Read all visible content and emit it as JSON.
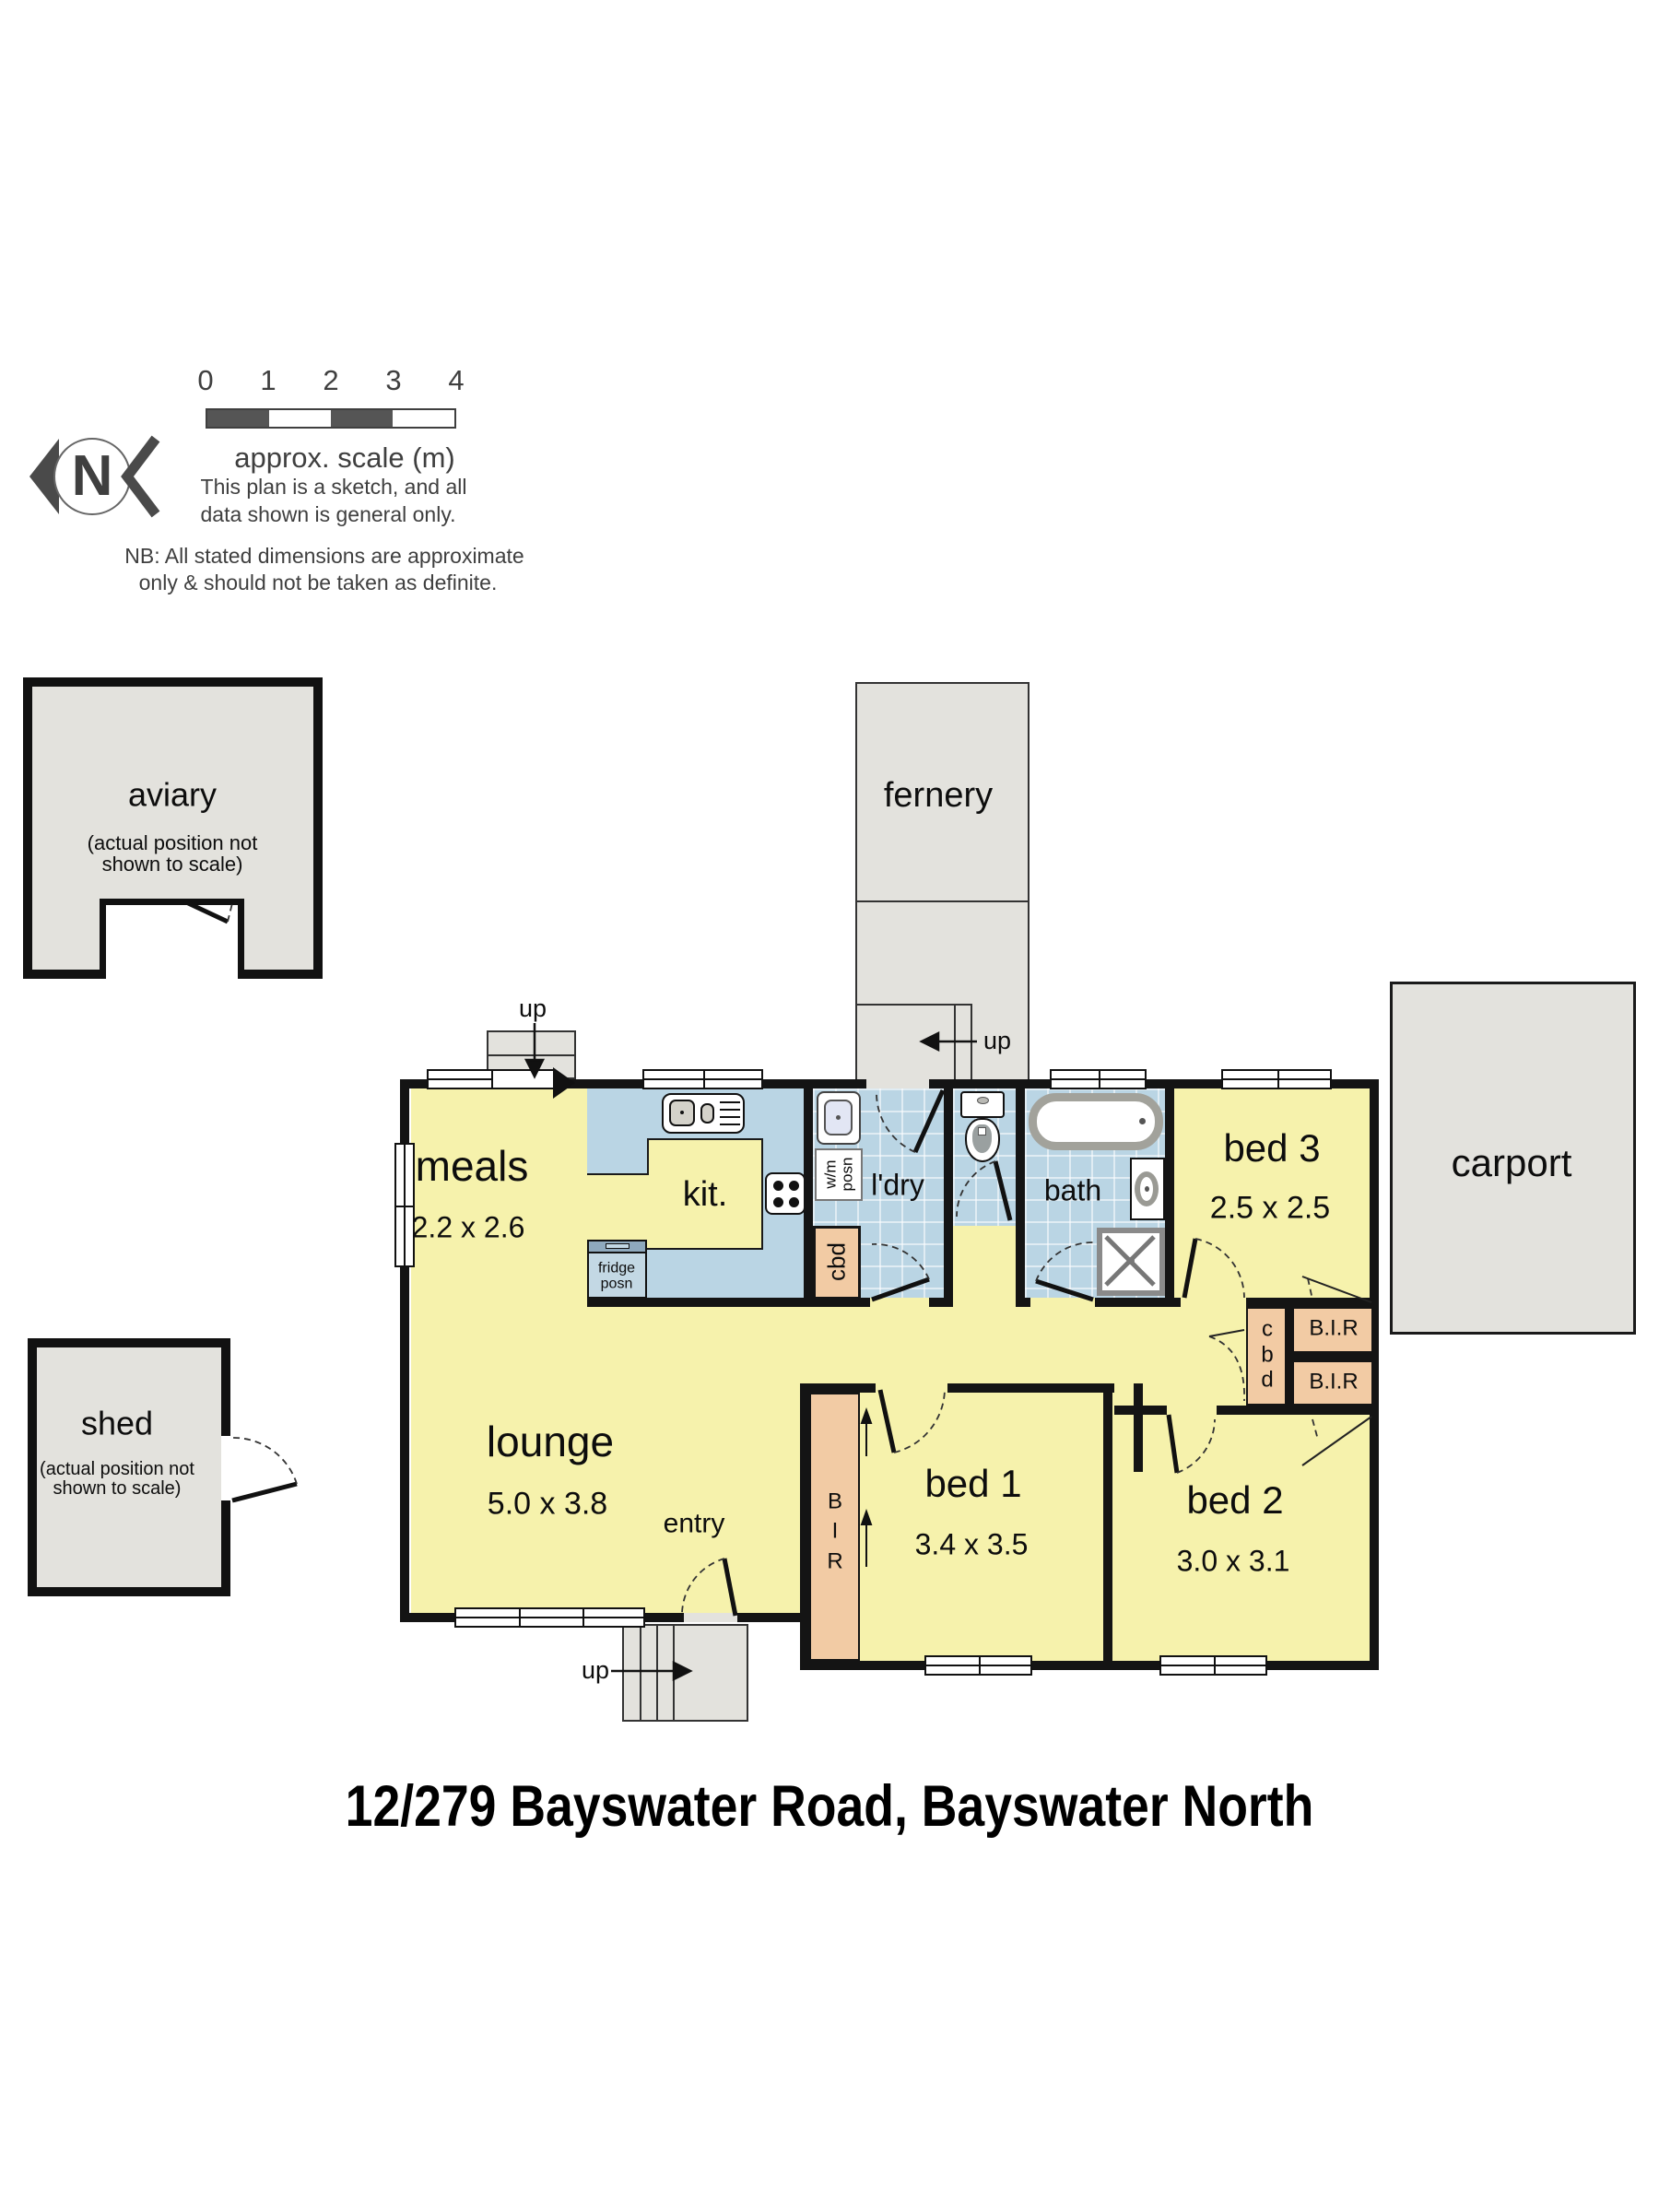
{
  "title": "12/279 Bayswater Road, Bayswater North",
  "legend": {
    "north_letter": "N",
    "scale_ticks": [
      "0",
      "1",
      "2",
      "3",
      "4"
    ],
    "scale_caption": "approx. scale (m)",
    "sketch_note_line1": "This plan is a sketch, and all",
    "sketch_note_line2": "data shown is general only.",
    "nb_note_line1": "NB: All stated dimensions are approximate",
    "nb_note_line2": "only & should not be taken as definite."
  },
  "outbuildings": {
    "aviary": {
      "name": "aviary",
      "note": "(actual position not\nshown to scale)"
    },
    "shed": {
      "name": "shed",
      "note": "(actual position not\nshown to scale)"
    },
    "fernery": {
      "name": "fernery"
    },
    "carport": {
      "name": "carport"
    }
  },
  "rooms": {
    "meals": {
      "name": "meals",
      "dims": "2.2 x 2.6"
    },
    "kitchen": {
      "name": "kit."
    },
    "laundry": {
      "name": "l'dry"
    },
    "bath": {
      "name": "bath"
    },
    "lounge": {
      "name": "lounge",
      "dims": "5.0 x 3.8"
    },
    "entry": {
      "name": "entry"
    },
    "bed1": {
      "name": "bed 1",
      "dims": "3.4 x 3.5"
    },
    "bed2": {
      "name": "bed 2",
      "dims": "3.0 x 3.1"
    },
    "bed3": {
      "name": "bed 3",
      "dims": "2.5 x 2.5"
    }
  },
  "fixtures": {
    "fridge": "fridge\nposn",
    "washing_machine": "w/m\nposn",
    "laundry_cupboard": "cbd",
    "hall_cupboard": "c\nb\nd",
    "robe1": "B.I.R",
    "robe2": "B.I.R",
    "entry_robe": "B\nI\nR"
  },
  "stairs": {
    "deck_up": "up",
    "fernery_up": "up",
    "porch_up": "up"
  },
  "colors": {
    "room_yellow": "#F6F2AC",
    "wet_blue": "#BAD5E4",
    "cupboard_orange": "#F2CBA4",
    "outdoor_grey": "#E3E2DD",
    "wall_black": "#141414"
  }
}
